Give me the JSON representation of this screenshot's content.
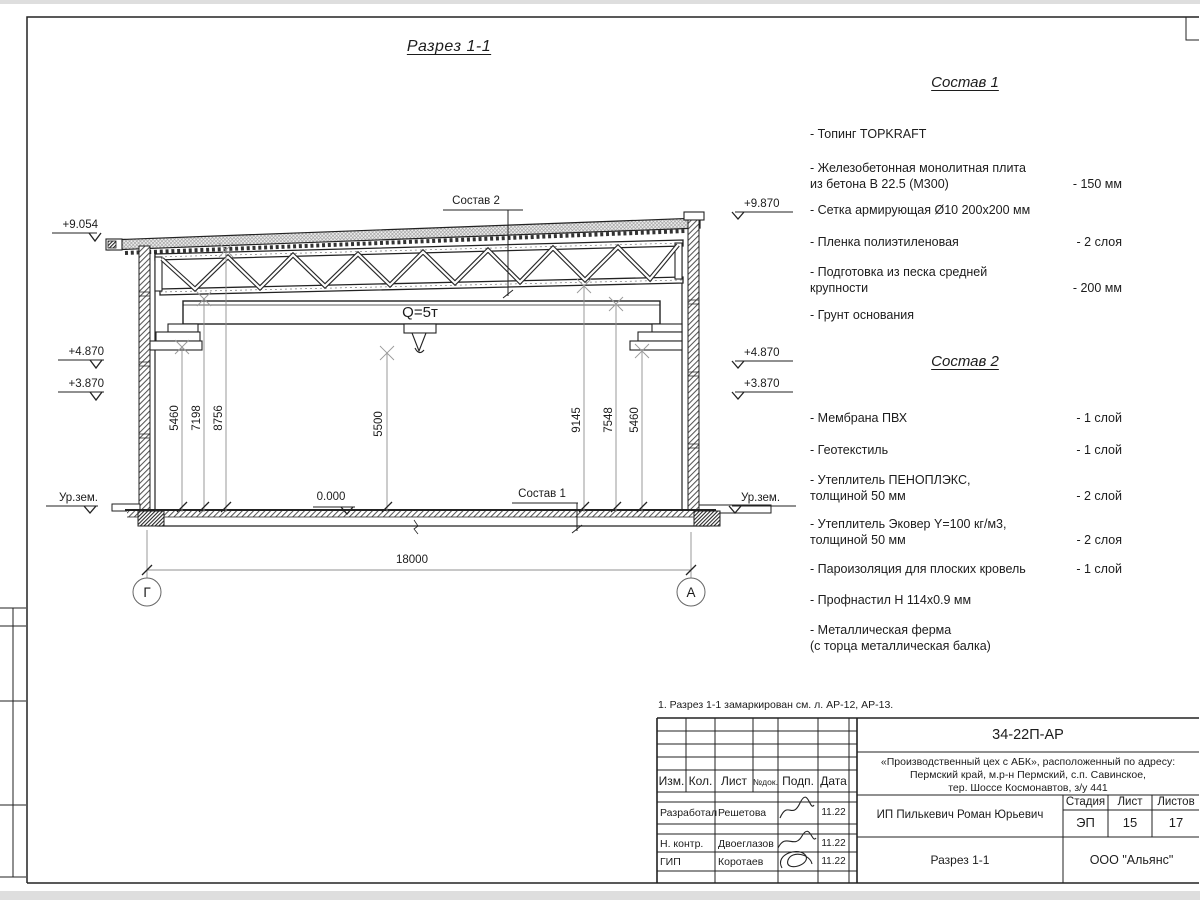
{
  "page": {
    "title": "Разрез 1-1"
  },
  "drawing": {
    "callouts": {
      "roof": "Состав 2",
      "floor": "Состав 1"
    },
    "crane": "Q=5т",
    "zero": "0.000",
    "levels_left": {
      "l1": "+9.054",
      "l2": "+4.870",
      "l3": "+3.870",
      "ground": "Ур.зем."
    },
    "levels_right": {
      "l1": "+9.870",
      "l2": "+4.870",
      "l3": "+3.870",
      "ground": "Ур.зем."
    },
    "dims": {
      "left1": "5460",
      "left2": "7198",
      "left3": "8756",
      "center": "5500",
      "right1": "9145",
      "right2": "7548",
      "right3": "5460",
      "span": "18000"
    },
    "axes": {
      "left": "Г",
      "right": "А"
    }
  },
  "legend1": {
    "title": "Состав 1",
    "items": [
      {
        "name": "- Топинг TOPKRAFT",
        "value": ""
      },
      {
        "name": "- Железобетонная  монолитная плита\nиз бетона В 22.5 (М300)",
        "value": "- 150 мм"
      },
      {
        "name": "- Сетка армирующая Ø10 200x200 мм",
        "value": ""
      },
      {
        "name": "- Пленка полиэтиленовая",
        "value": "-  2 слоя"
      },
      {
        "name": "- Подготовка из песка средней\nкрупности",
        "value": "- 200 мм"
      },
      {
        "name": "- Грунт основания",
        "value": ""
      }
    ]
  },
  "legend2": {
    "title": "Состав 2",
    "items": [
      {
        "name": "- Мембрана ПВХ",
        "value": "- 1 слой"
      },
      {
        "name": "- Геотекстиль",
        "value": "- 1 слой"
      },
      {
        "name": "- Утеплитель ПЕНОПЛЭКС,\nтолщиной 50 мм",
        "value": "- 2 слой"
      },
      {
        "name": "- Утеплитель Эковер Y=100 кг/м3,\nтолщиной 50 мм",
        "value": "- 2 слоя"
      },
      {
        "name": "- Пароизоляция для плоских кровель",
        "value": "- 1 слой"
      },
      {
        "name": "- Профнастил Н 114x0.9 мм",
        "value": ""
      },
      {
        "name": "- Металлическая ферма\n(с торца металлическая балка)",
        "value": ""
      }
    ]
  },
  "note": "1. Разрез 1-1 замаркирован см. л. АР-12, АР-13.",
  "titleblock": {
    "doc_number": "34-22П-АР",
    "project": "«Производственный цех с АБК», расположенный по адресу:\nПермский край, м.р-н Пермский, с.п. Савинское,\nтер. Шоссе Космонавтов, з/у 441",
    "client": "ИП Пилькевич Роман Юрьевич",
    "sheet_title": "Разрез 1-1",
    "company": "ООО \"Альянс\"",
    "cols": {
      "izm": "Изм.",
      "kol": "Кол.",
      "list": "Лист",
      "ndoc": "№док.",
      "podp": "Подп.",
      "data": "Дата"
    },
    "stage_label": "Стадия",
    "sheet_label": "Лист",
    "sheets_label": "Листов",
    "stage": "ЭП",
    "sheet_no": "15",
    "sheets_total": "17",
    "rows": [
      {
        "role": "Разработал",
        "name": "Решетова",
        "date": "11.22"
      },
      {
        "role": "Н. контр.",
        "name": "Двоеглазов",
        "date": "11.22"
      },
      {
        "role": "ГИП",
        "name": "Коротаев",
        "date": "11.22"
      }
    ]
  }
}
